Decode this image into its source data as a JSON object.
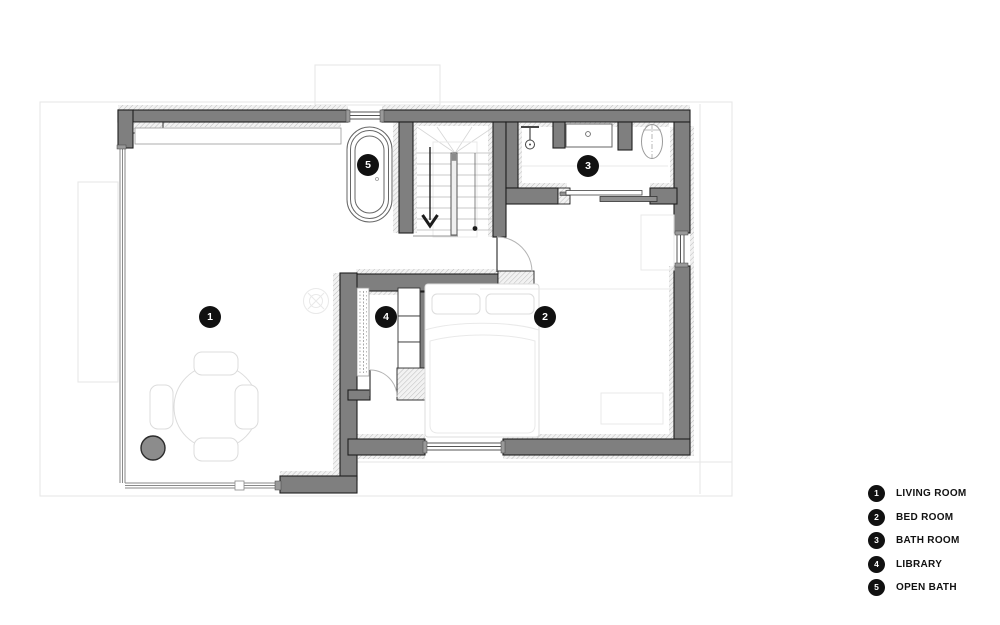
{
  "legend": {
    "items": [
      {
        "number": "1",
        "label": "LIVING ROOM"
      },
      {
        "number": "2",
        "label": "BED ROOM"
      },
      {
        "number": "3",
        "label": "BATH ROOM"
      },
      {
        "number": "4",
        "label": "LIBRARY"
      },
      {
        "number": "5",
        "label": "OPEN BATH"
      }
    ]
  },
  "colors": {
    "wall_fill": "#7f7f7f",
    "wall_stroke": "#1f1f1f",
    "hatch_line": "#bdbdbd",
    "marker_bg": "#111111",
    "marker_text": "#ffffff",
    "furniture_light": "#dcdcdc",
    "background": "#ffffff"
  }
}
